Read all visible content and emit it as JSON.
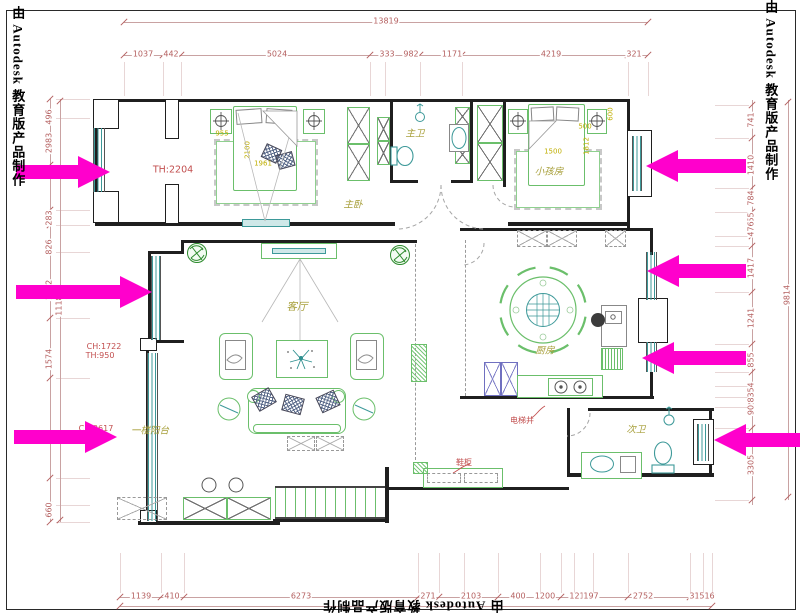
{
  "watermark": {
    "text": "由 Autodesk 教育版产品制作"
  },
  "dimensions": {
    "top": {
      "overall": "13819",
      "segments": [
        "1037",
        "442",
        "5024",
        "333",
        "982",
        "1171",
        "4219",
        "321"
      ]
    },
    "bottom": {
      "segments": [
        "1139",
        "410",
        "6273",
        "271",
        "2103",
        "400",
        "1200",
        "121",
        "197",
        "2752",
        "315",
        "516"
      ]
    },
    "left": {
      "overall": "11181",
      "segments": [
        "496",
        "2983",
        "283",
        "826",
        "1712",
        "1574",
        "660"
      ]
    },
    "right": {
      "overall": "9814",
      "segments": [
        "741",
        "1410",
        "784",
        "955",
        "476",
        "1417",
        "1241",
        "855",
        "954",
        "283",
        "90",
        "3305"
      ]
    }
  },
  "rooms": {
    "master_bedroom": "主卧",
    "master_bath": "主卫",
    "kids_room": "小孩房",
    "living_room": "客厅",
    "kitchen": "厨房",
    "second_bath": "次卫",
    "balcony": "一楼阳台"
  },
  "annotations": {
    "unit_number": "TH:2204",
    "ceiling_height_1": "CH:1722",
    "ceiling_height_1b": "TH:950",
    "ceiling_height_2": "CH:2617",
    "shaft": "电梯井",
    "shoe_cabinet": "鞋柜"
  },
  "furniture_dims": {
    "master": [
      "955",
      "2100",
      "1961"
    ],
    "kids": [
      "1500",
      "500",
      "600",
      "1812"
    ]
  },
  "colors": {
    "wall": "#1f1f1f",
    "furniture_green": "#6bbf6b",
    "fixture_teal": "#3d9999",
    "room_label_olive": "#a8a03c",
    "dim_red": "#b45f5f",
    "yellow_dim": "#bfae00",
    "annotation_red": "#c24f4f",
    "arrow_magenta": "#ff00cc"
  }
}
